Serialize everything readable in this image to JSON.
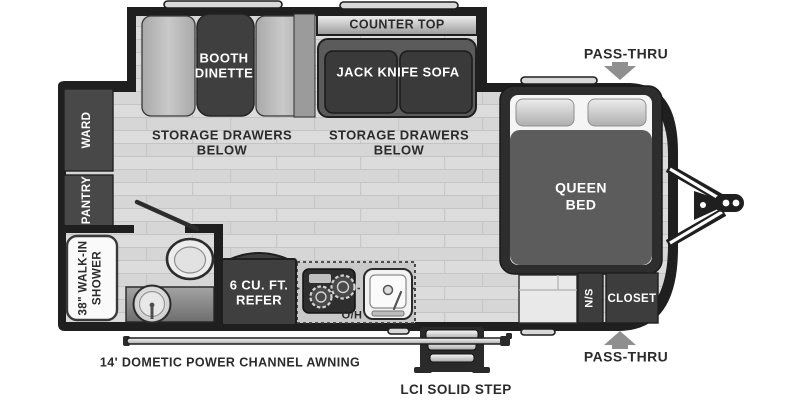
{
  "colors": {
    "wall": "#1f1f1f",
    "furniture_dark": "#3d3d3d",
    "floor": "#d9d9d9",
    "arrow_gray": "#8f8f8f",
    "text_dark": "#2b2b2b",
    "text_light": "#ffffff"
  },
  "slide_section": {
    "counter_top": "COUNTER TOP",
    "booth_dinette": "BOOTH\nDINETTE",
    "jack_knife_sofa": "JACK KNIFE SOFA",
    "storage_left": "STORAGE DRAWERS\nBELOW",
    "storage_right": "STORAGE DRAWERS\nBELOW"
  },
  "rear_section": {
    "ward": "WARD",
    "pantry": "PANTRY",
    "shower": "38\" WALK-IN\nSHOWER"
  },
  "kitchen": {
    "refrigerator": "6 CU. FT.\nREFER",
    "overhead": "O/H"
  },
  "bedroom": {
    "bed": "QUEEN\nBED",
    "nightstand": "N/S",
    "closet": "CLOSET",
    "pass_thru_top": "PASS-THRU",
    "pass_thru_bottom": "PASS-THRU"
  },
  "exterior": {
    "awning": "14' DOMETIC POWER CHANNEL AWNING",
    "step": "LCI SOLID STEP"
  }
}
